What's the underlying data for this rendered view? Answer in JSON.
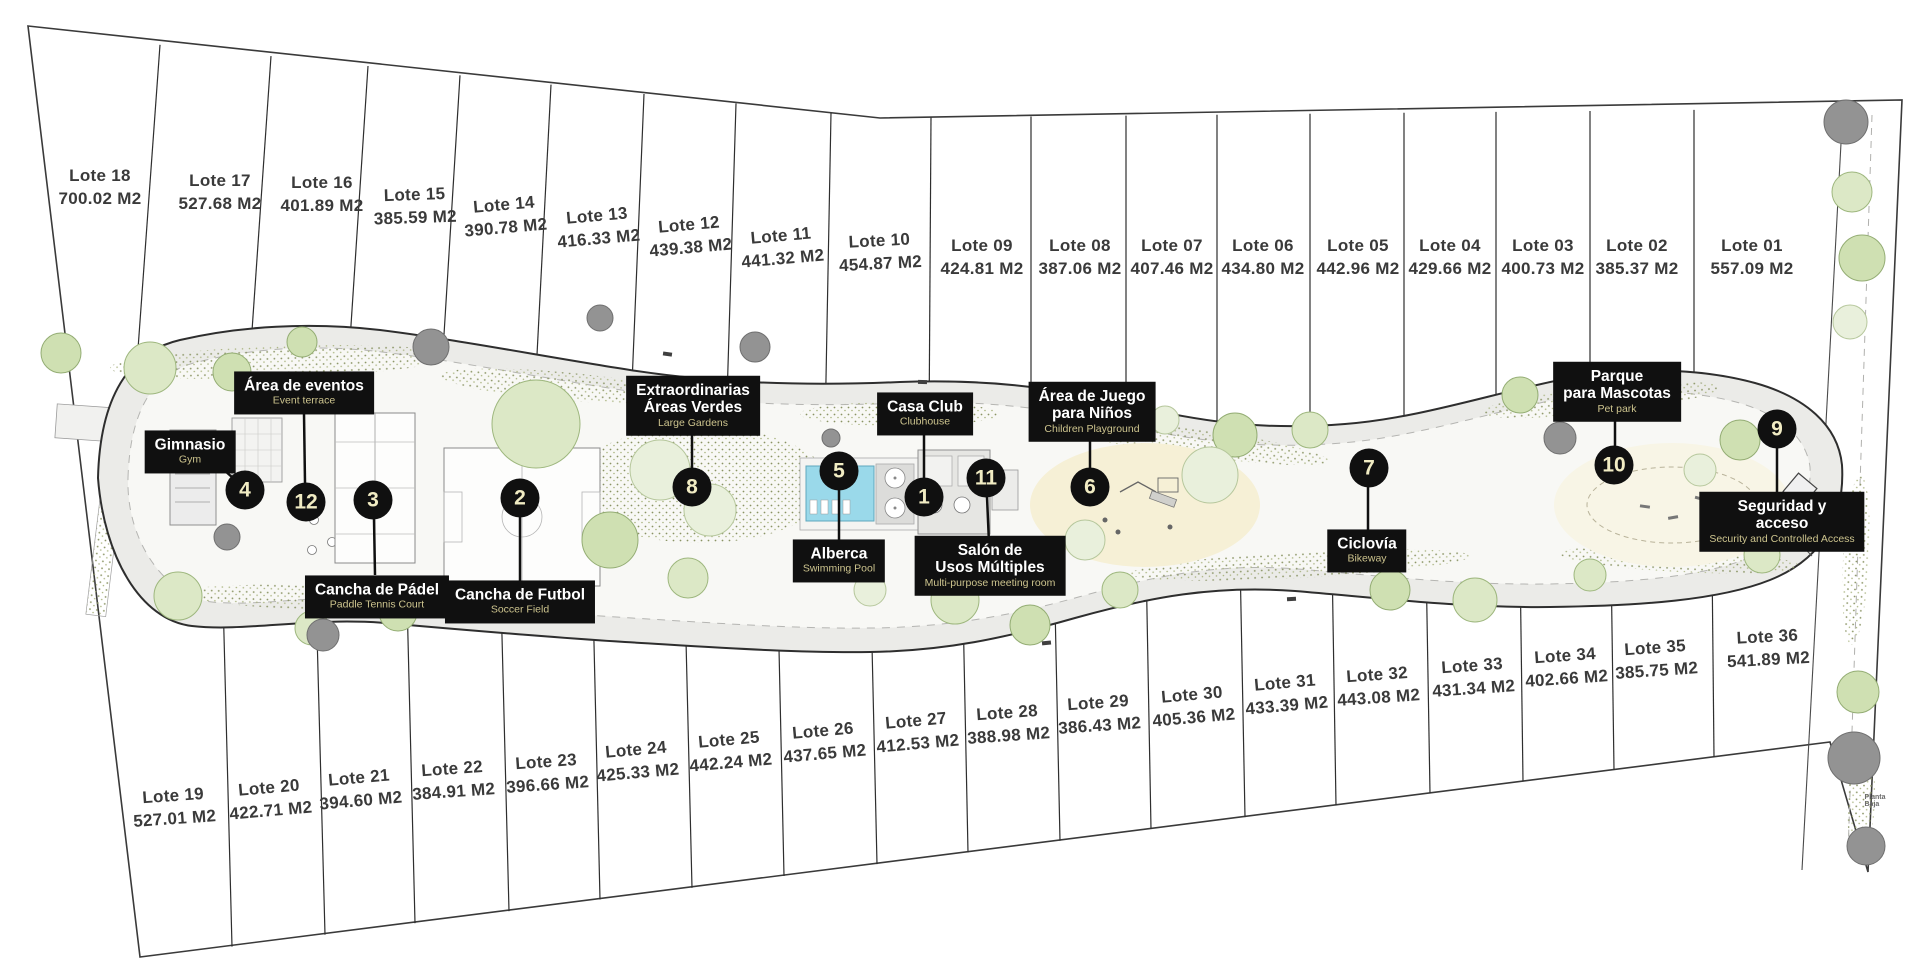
{
  "plan": {
    "footnote": "Planta Baja"
  },
  "colors": {
    "label_bg": "#101010",
    "label_title": "#ffffff",
    "label_sub": "#cdc48e",
    "marker_text": "#f1ecc3",
    "pool": "#9ad9ea",
    "site_line": "#3a3a3a",
    "belt_fill": "#ebebe8",
    "tree_green": "#dce8c6"
  },
  "lots": [
    {
      "name": "Lote 18",
      "area": "700.02 M2"
    },
    {
      "name": "Lote 17",
      "area": "527.68 M2"
    },
    {
      "name": "Lote 16",
      "area": "401.89 M2"
    },
    {
      "name": "Lote 15",
      "area": "385.59 M2"
    },
    {
      "name": "Lote 14",
      "area": "390.78 M2"
    },
    {
      "name": "Lote 13",
      "area": "416.33 M2"
    },
    {
      "name": "Lote 12",
      "area": "439.38 M2"
    },
    {
      "name": "Lote 11",
      "area": "441.32 M2"
    },
    {
      "name": "Lote 10",
      "area": "454.87 M2"
    },
    {
      "name": "Lote 09",
      "area": "424.81 M2"
    },
    {
      "name": "Lote 08",
      "area": "387.06 M2"
    },
    {
      "name": "Lote 07",
      "area": "407.46 M2"
    },
    {
      "name": "Lote 06",
      "area": "434.80 M2"
    },
    {
      "name": "Lote 05",
      "area": "442.96 M2"
    },
    {
      "name": "Lote 04",
      "area": "429.66 M2"
    },
    {
      "name": "Lote 03",
      "area": "400.73 M2"
    },
    {
      "name": "Lote 02",
      "area": "385.37 M2"
    },
    {
      "name": "Lote 01",
      "area": "557.09 M2"
    },
    {
      "name": "Lote 19",
      "area": "527.01 M2"
    },
    {
      "name": "Lote 20",
      "area": "422.71 M2"
    },
    {
      "name": "Lote 21",
      "area": "394.60 M2"
    },
    {
      "name": "Lote 22",
      "area": "384.91 M2"
    },
    {
      "name": "Lote 23",
      "area": "396.66 M2"
    },
    {
      "name": "Lote 24",
      "area": "425.33 M2"
    },
    {
      "name": "Lote 25",
      "area": "442.24 M2"
    },
    {
      "name": "Lote 26",
      "area": "437.65 M2"
    },
    {
      "name": "Lote 27",
      "area": "412.53 M2"
    },
    {
      "name": "Lote 28",
      "area": "388.98 M2"
    },
    {
      "name": "Lote 29",
      "area": "386.43 M2"
    },
    {
      "name": "Lote 30",
      "area": "405.36 M2"
    },
    {
      "name": "Lote 31",
      "area": "433.39 M2"
    },
    {
      "name": "Lote 32",
      "area": "443.08 M2"
    },
    {
      "name": "Lote 33",
      "area": "431.34 M2"
    },
    {
      "name": "Lote 34",
      "area": "402.66 M2"
    },
    {
      "name": "Lote 35",
      "area": "385.75 M2"
    },
    {
      "name": "Lote 36",
      "area": "541.89 M2"
    }
  ],
  "amenities": [
    {
      "num": "12",
      "title": "Área de eventos",
      "subtitle": "Event terrace"
    },
    {
      "num": "4",
      "title": "Gimnasio",
      "subtitle": "Gym"
    },
    {
      "num": "3",
      "title": "Cancha de Pádel",
      "subtitle": "Paddle Tennis Court"
    },
    {
      "num": "2",
      "title": "Cancha de Futbol",
      "subtitle": "Soccer Field"
    },
    {
      "num": "8",
      "title": "Extraordinarias\nÁreas Verdes",
      "subtitle": "Large Gardens"
    },
    {
      "num": "5",
      "title": "Alberca",
      "subtitle": "Swimming Pool"
    },
    {
      "num": "1",
      "title": "Casa Club",
      "subtitle": "Clubhouse"
    },
    {
      "num": "11",
      "title": "Salón de\nUsos Múltiples",
      "subtitle": "Multi-purpose meeting room"
    },
    {
      "num": "6",
      "title": "Área de Juego\npara Niños",
      "subtitle": "Children Playground"
    },
    {
      "num": "7",
      "title": "Ciclovía",
      "subtitle": "Bikeway"
    },
    {
      "num": "10",
      "title": "Parque\npara Mascotas",
      "subtitle": "Pet park"
    },
    {
      "num": "9",
      "title": "Seguridad y acceso",
      "subtitle": "Security and Controlled Access"
    }
  ]
}
